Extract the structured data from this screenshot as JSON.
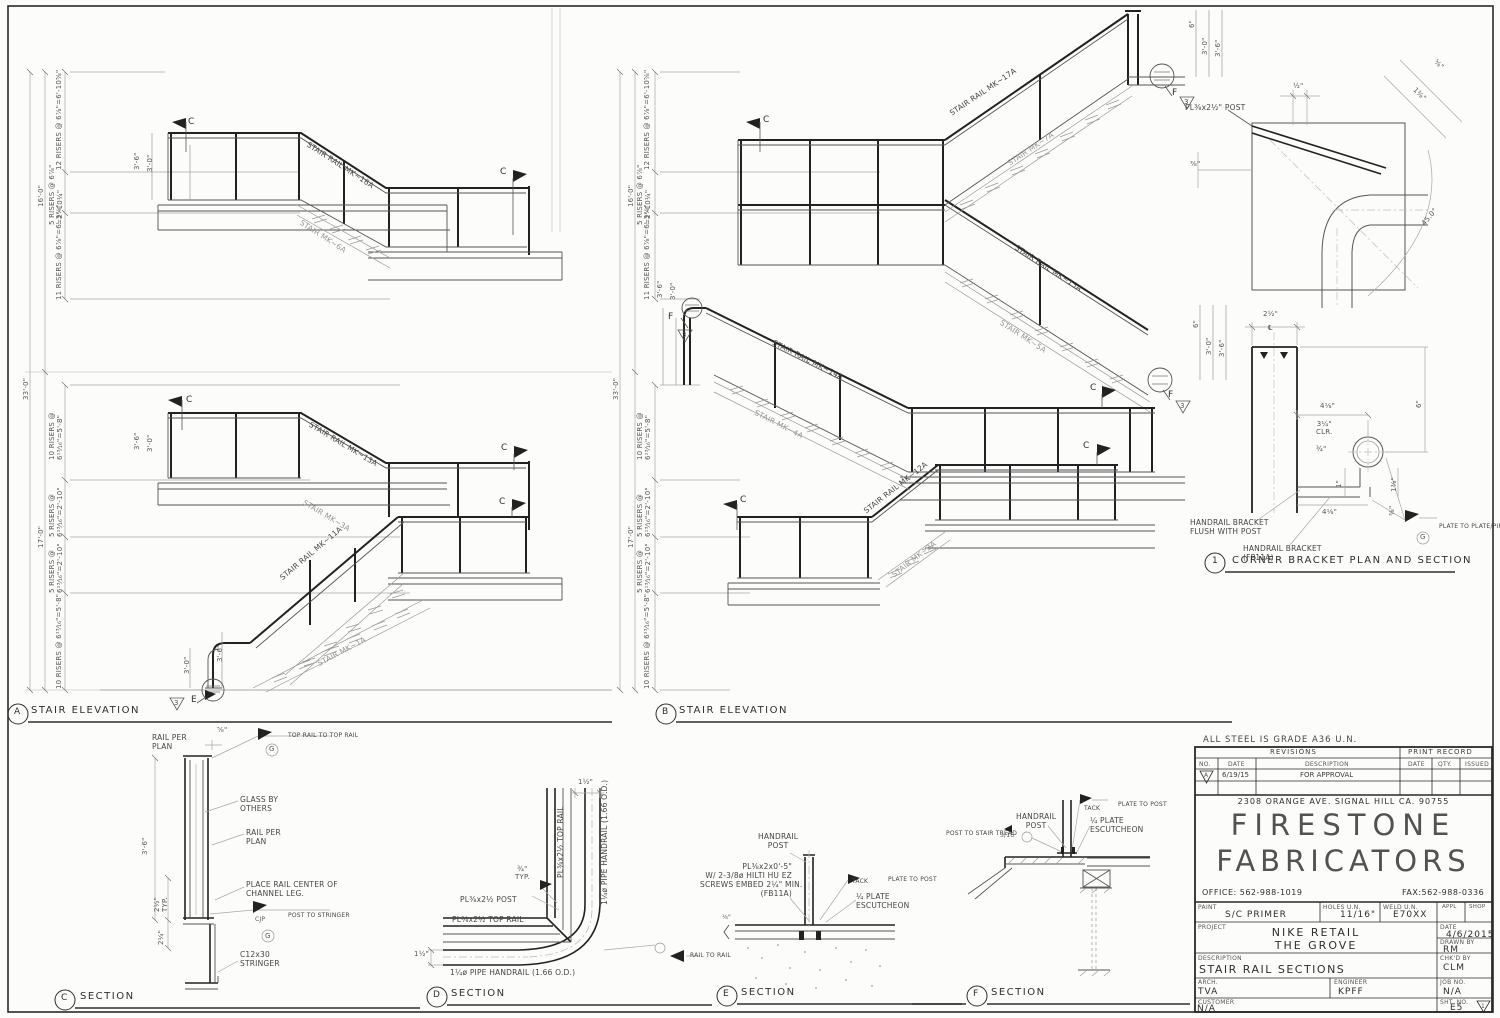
{
  "sheet": {
    "steel_note": "ALL STEEL IS GRADE A36 U.N."
  },
  "elev_a": {
    "marker": "A",
    "title": "STAIR ELEVATION",
    "dim_overall": "33'-0\"",
    "dim_upper": "16'-0\"",
    "dim_lower": "17'-0\"",
    "seg_u1": "12 RISERS @ 6⅞\"=6'-10⅝\"",
    "seg_u2": "5 RISERS @ 6⅞\"\n=2'-10¼\"",
    "seg_u3": "11 RISERS @ 6⅞\"=6'-3⅜\"",
    "seg_l1": "10 RISERS @\n6¹³⁄₁₆\"=5'-8\"",
    "seg_l2": "5 RISERS @\n6¹³⁄₁₆\"=2'-10\"",
    "seg_l3": "5 RISERS @\n6¹³⁄₁₆\"=2'-10\"",
    "seg_l4": "10 RISERS @ 6¹³⁄₁₆\"=5'-8\"",
    "rail_16": "STAIR RAIL MK~16A",
    "stair_6": "STAIR MK~6A",
    "rail_13": "STAIR RAIL MK~13A",
    "stair_3": "STAIR MK~3A",
    "rail_11": "STAIR RAIL MK~11A",
    "stair_1": "STAIR MK~1A",
    "h36": "3'-6\"",
    "h30": "3'-0\"",
    "flag_c": "C",
    "detail_tri": "3",
    "detail_flag": "E"
  },
  "elev_b": {
    "marker": "B",
    "title": "STAIR ELEVATION",
    "dim_overall": "33'-0\"",
    "dim_upper": "16'-0\"",
    "dim_lower": "17'-0\"",
    "seg_u1": "12 RISERS @ 6⅞\"=6'-10⅝\"",
    "seg_u2": "5 RISERS @ 6⅞\"\n=2'-10¼\"",
    "seg_u3": "11 RISERS @ 6⅞\"=6'-3⅜\"",
    "seg_l1": "10 RISERS @\n6¹³⁄₁₆\"=5'-8\"",
    "seg_l2": "5 RISERS @\n6¹³⁄₁₆\"=2'-10\"",
    "seg_l3": "5 RISERS @\n6¹³⁄₁₆\"=2'-10\"",
    "seg_l4": "10 RISERS @ 6¹³⁄₁₆\"=5'-8\"",
    "rail_17": "STAIR RAIL MK~17A",
    "stair_7": "STAIR MK~7A",
    "rail_15": "STAIR RAIL MK~15A",
    "stair_5": "STAIR MK~5A",
    "rail_14": "STAIR RAIL MK~14A",
    "stair_4": "STAIR MK~4A",
    "rail_12": "STAIR RAIL MK~12A",
    "stair_2": "STAIR MK~2A",
    "h36": "3'-6\"",
    "h30": "3'-0\"",
    "h6": "6\"",
    "flag_c": "C",
    "flag_f": "F",
    "detail_tri": "3"
  },
  "detail1": {
    "marker": "1",
    "title": "CORNER BRACKET PLAN AND SECTION",
    "post_label": "PL⅜x2½\" POST",
    "dim_half": "½\"",
    "dim_58": "⅝\"",
    "dim_138": "1⅜\"",
    "dim_38": "⅜\"",
    "angle": "45.0°",
    "dim_212": "2½\"",
    "cl": "℄",
    "dim_6": "6\"",
    "dim_418_top": "4⅛\"",
    "dim_314_clr": "3¼\"\nCLR.",
    "dim_34": "¾\"",
    "dim_1": "1\"",
    "dim_138b": "1⅜\"",
    "dim_38b": "⅜\"",
    "dim_418_bot": "4⅛\"",
    "note_flush": "HANDRAIL BRACKET\nFLUSH WITH POST",
    "note_fp": "HANDRAIL BRACKET\n(FP11A)",
    "weld_plate": "PLATE TO PLATE/PIPE",
    "g": "G"
  },
  "sec_c": {
    "marker": "C",
    "title": "SECTION",
    "rail_top": "RAIL PER\nPLAN",
    "dim_58": "⅝\"",
    "weld_top": "TOP RAIL TO TOP RAIL",
    "g": "G",
    "glass": "GLASS BY\nOTHERS",
    "rail_mid": "RAIL PER\nPLAN",
    "place_rail": "PLACE RAIL CENTER OF\nCHANNEL LEG.",
    "cjp": "CJP",
    "weld_post": "POST TO STRINGER",
    "stringer": "C12x30\nSTRINGER",
    "dim_36": "3'-6\"",
    "dim_212": "2½\"\nTYP.",
    "dim_214": "2¼\""
  },
  "sec_d": {
    "marker": "D",
    "title": "SECTION",
    "dim_112_top": "1½\"",
    "dim_112_left": "1½\"",
    "top_rail_v": "PL⅜x2½ TOP RAIL",
    "pipe_v": "1¼ø PIPE HANDRAIL (1.66 O.D.)",
    "post": "PL⅜x2½ POST",
    "dim_34": "¾\"\nTYP.",
    "top_rail_h": "PL⅜x2½ TOP RAIL",
    "pipe_h": "1¼ø PIPE HANDRAIL (1.66 O.D.)"
  },
  "sec_e": {
    "marker": "E",
    "title": "SECTION",
    "post": "HANDRAIL\nPOST",
    "plate_note": "PL⅜x2x0'-5\"\nW/ 2-3/8ø HILTI HU EZ\nSCREWS EMBED 2¼\" MIN.\n(FB11A)",
    "tack": "TACK",
    "plate_to_post": "PLATE TO POST",
    "escutcheon": "¼ PLATE\nESCUTCHEON",
    "rail_to_rail": "RAIL TO RAIL",
    "dim_18": "⅛\""
  },
  "sec_f": {
    "marker": "F",
    "title": "SECTION",
    "post_to_tread": "POST TO STAIR TREAD",
    "weld_316": "3/16",
    "post": "HANDRAIL\nPOST",
    "tack": "TACK",
    "plate_to_post": "PLATE TO POST",
    "escutcheon": "¼ PLATE\nESCUTCHEON"
  },
  "title_block": {
    "revisions": "REVISIONS",
    "print_record": "PRINT RECORD",
    "col_no": "NO.",
    "col_date": "DATE",
    "col_desc": "DESCRIPTION",
    "col_date2": "DATE",
    "col_qty": "QTY.",
    "col_issued": "ISSUED",
    "rev_mark": "A",
    "rev_date": "6/19/15",
    "rev_desc": "FOR APPROVAL",
    "address": "2308 ORANGE AVE. SIGNAL HILL CA. 90755",
    "company1": "FIRESTONE",
    "company2": "FABRICATORS",
    "office": "OFFICE: 562-988-1019",
    "fax": "FAX:562-988-0336",
    "paint_label": "PAINT",
    "paint": "S/C PRIMER",
    "holes_label": "HOLES U.N.",
    "holes": "11/16\"",
    "weld_label": "WELD U.N.",
    "weld": "E70XX",
    "appl": "APPL",
    "shop": "SHOP",
    "project_label": "PROJECT",
    "project1": "NIKE RETAIL",
    "project2": "THE GROVE",
    "date_label": "DATE",
    "date": "4/6/2015",
    "drawn_label": "DRAWN BY",
    "drawn": "RM",
    "desc_label": "DESCRIPTION",
    "desc": "STAIR RAIL SECTIONS",
    "chk_label": "CHK'D BY",
    "chk": "CLM",
    "arch_label": "ARCH.",
    "arch": "TVA",
    "eng_label": "ENGINEER",
    "eng": "KPFF",
    "job_label": "JOB NO.",
    "job": "N/A",
    "customer_label": "CUSTOMER",
    "customer": "N/A",
    "sht_label": "SHT. NO.",
    "sht": "E5",
    "sht_rev": "1"
  }
}
